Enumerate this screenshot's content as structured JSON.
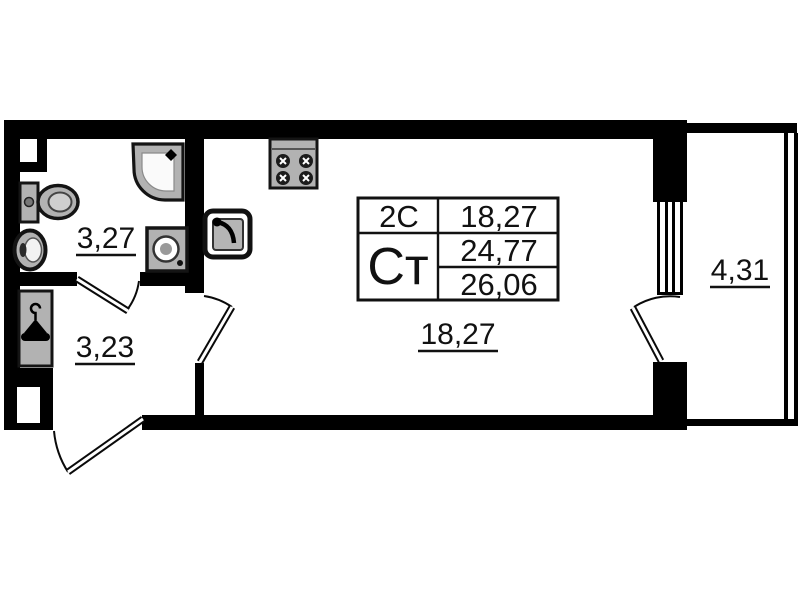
{
  "plan": {
    "info_table": {
      "type_code": "2С",
      "living_area": "18,27",
      "unit_code": "Ст",
      "area_total": "24,77",
      "area_with_balcony": "26,06"
    },
    "rooms": {
      "bathroom": "3,27",
      "hallway": "3,23",
      "living": "18,27",
      "balcony": "4,31"
    },
    "fixtures": [
      "shower-icon",
      "toilet-icon",
      "bath-sink-icon",
      "washing-machine-icon",
      "kitchen-sink-icon",
      "stove-icon",
      "wardrobe-icon"
    ],
    "colors": {
      "wall": "#000000",
      "background": "#ffffff",
      "fixture_fill": "#b2b2b2"
    }
  }
}
